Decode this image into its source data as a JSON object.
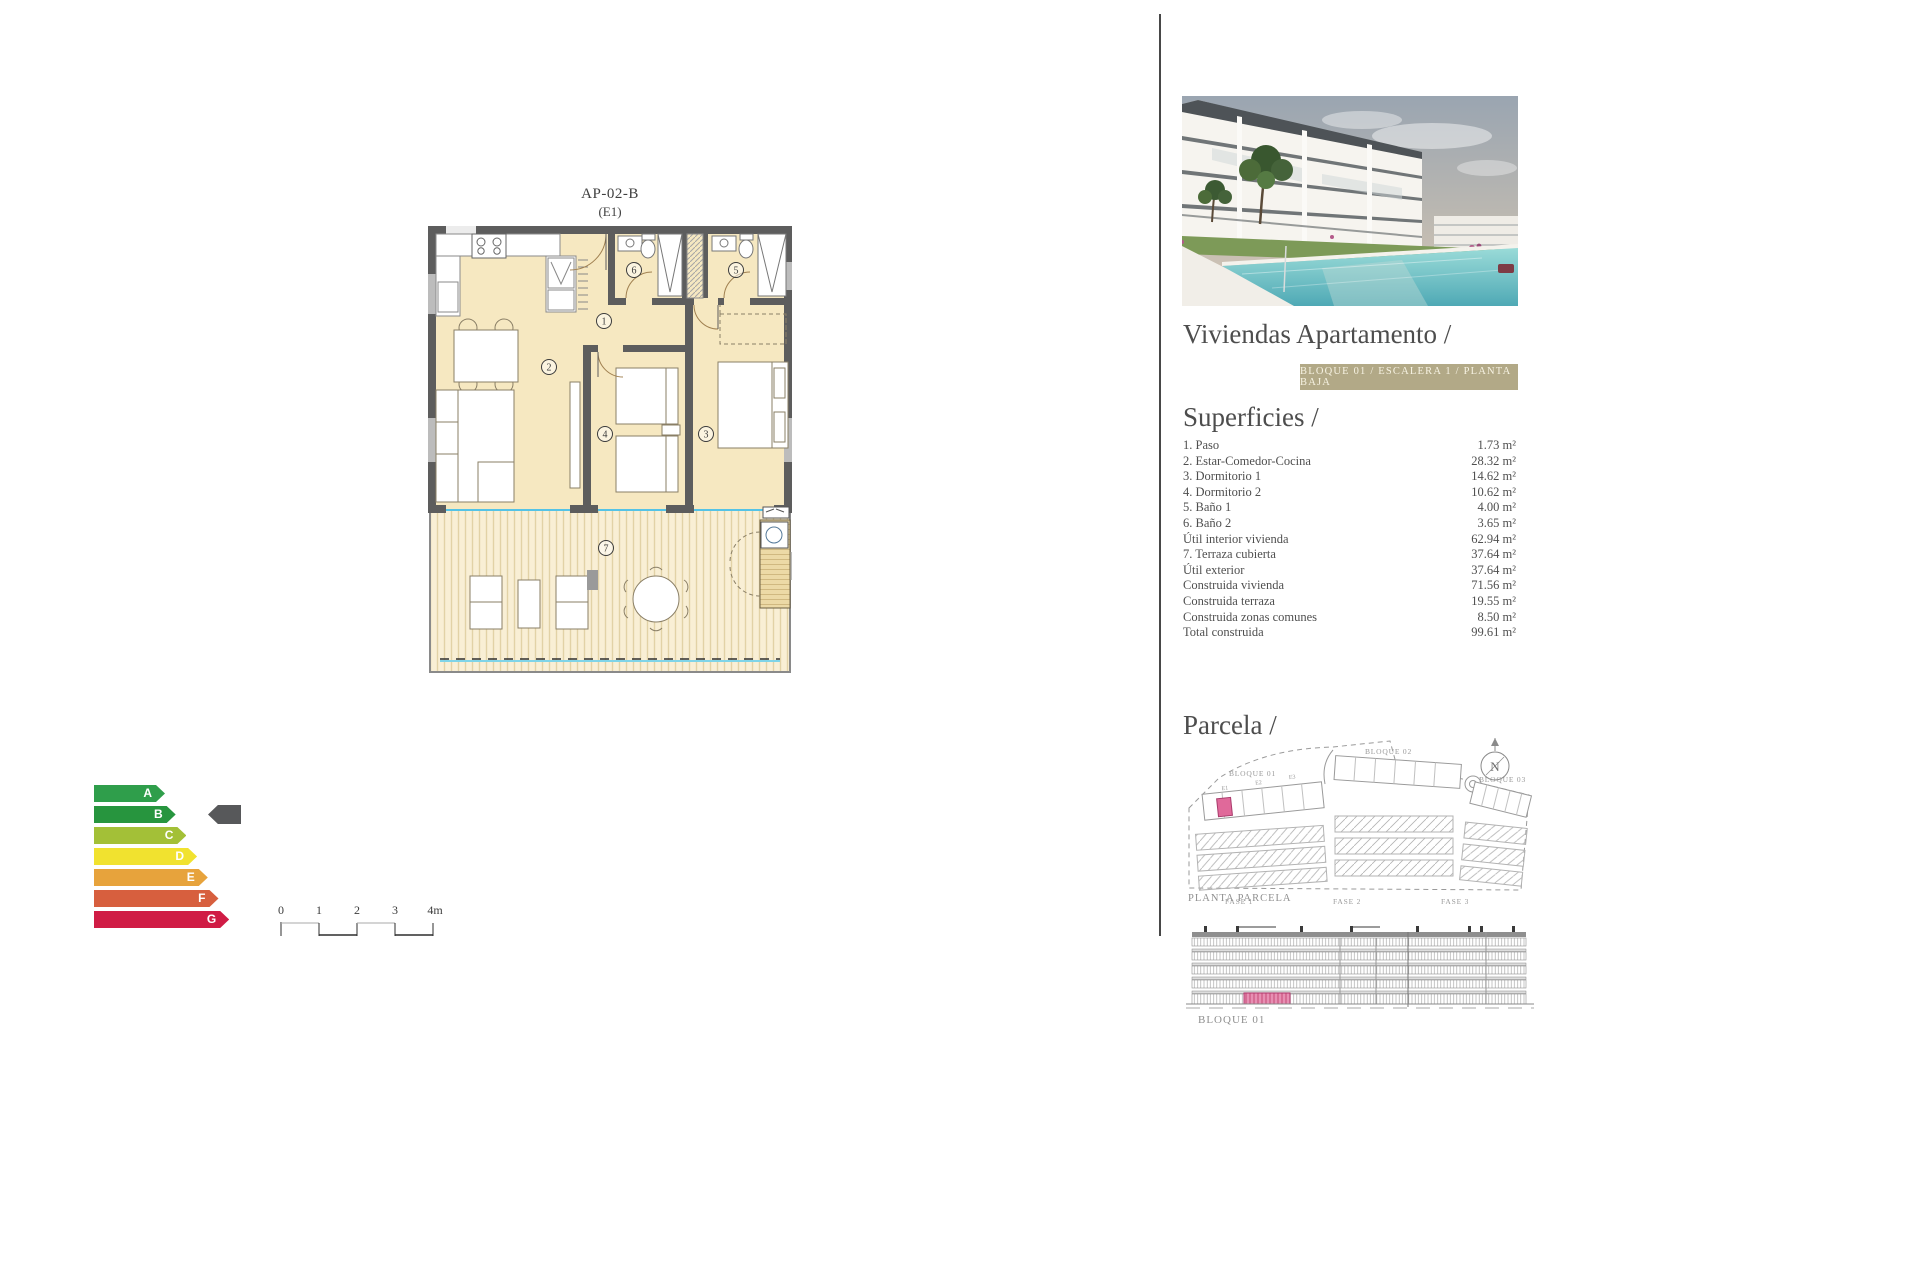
{
  "plan": {
    "title": "AP-02-B",
    "variant": "(E1)",
    "rooms": [
      {
        "n": "1"
      },
      {
        "n": "2"
      },
      {
        "n": "3"
      },
      {
        "n": "4"
      },
      {
        "n": "5"
      },
      {
        "n": "6"
      },
      {
        "n": "7"
      }
    ]
  },
  "energy": {
    "levels": [
      {
        "letter": "A",
        "color": "#2f9e4b"
      },
      {
        "letter": "B",
        "color": "#27953e"
      },
      {
        "letter": "C",
        "color": "#a3c037"
      },
      {
        "letter": "D",
        "color": "#f1e22f"
      },
      {
        "letter": "E",
        "color": "#e7a33c"
      },
      {
        "letter": "F",
        "color": "#d75f3e"
      },
      {
        "letter": "G",
        "color": "#d01c45"
      }
    ],
    "current": "B",
    "pointer_color": "#57585a"
  },
  "scale_bar": {
    "labels": [
      "0",
      "1",
      "2",
      "3",
      "4m"
    ]
  },
  "sidebar": {
    "title": "Viviendas Apartamento /",
    "badge": "BLOQUE 01 / ESCALERA 1 / PLANTA BAJA",
    "badge_bg": "#b2a987",
    "superficies": {
      "heading": "Superficies /",
      "rows": [
        {
          "label": "1. Paso",
          "value": "1.73 m²"
        },
        {
          "label": "2. Estar-Comedor-Cocina",
          "value": "28.32 m²"
        },
        {
          "label": "3. Dormitorio 1",
          "value": "14.62 m²"
        },
        {
          "label": "4. Dormitorio 2",
          "value": "10.62 m²"
        },
        {
          "label": "5. Baño 1",
          "value": "4.00 m²"
        },
        {
          "label": "6. Baño 2",
          "value": "3.65 m²"
        },
        {
          "label": "Útil interior vivienda",
          "value": "62.94 m²"
        },
        {
          "label": "7. Terraza cubierta",
          "value": "37.64 m²"
        },
        {
          "label": "Útil exterior",
          "value": "37.64 m²"
        },
        {
          "label": "Construida vivienda",
          "value": "71.56 m²"
        },
        {
          "label": "Construida terraza",
          "value": "19.55 m²"
        },
        {
          "label": "Construida zonas comunes",
          "value": "8.50 m²"
        },
        {
          "label": "Total construida",
          "value": "99.61 m²"
        }
      ]
    },
    "parcela": {
      "heading": "Parcela /",
      "blocks": [
        "BLOQUE 01",
        "BLOQUE 02",
        "BLOQUE 03"
      ],
      "units": [
        "E1",
        "E2",
        "E3"
      ],
      "fases": [
        "FASE 1",
        "FASE 2",
        "FASE 3"
      ],
      "caption": "PLANTA PARCELA",
      "compass": "N",
      "highlight_color": "#e0699a"
    },
    "elevation": {
      "caption": "BLOQUE 01",
      "highlight_color": "#e78fb3"
    }
  }
}
